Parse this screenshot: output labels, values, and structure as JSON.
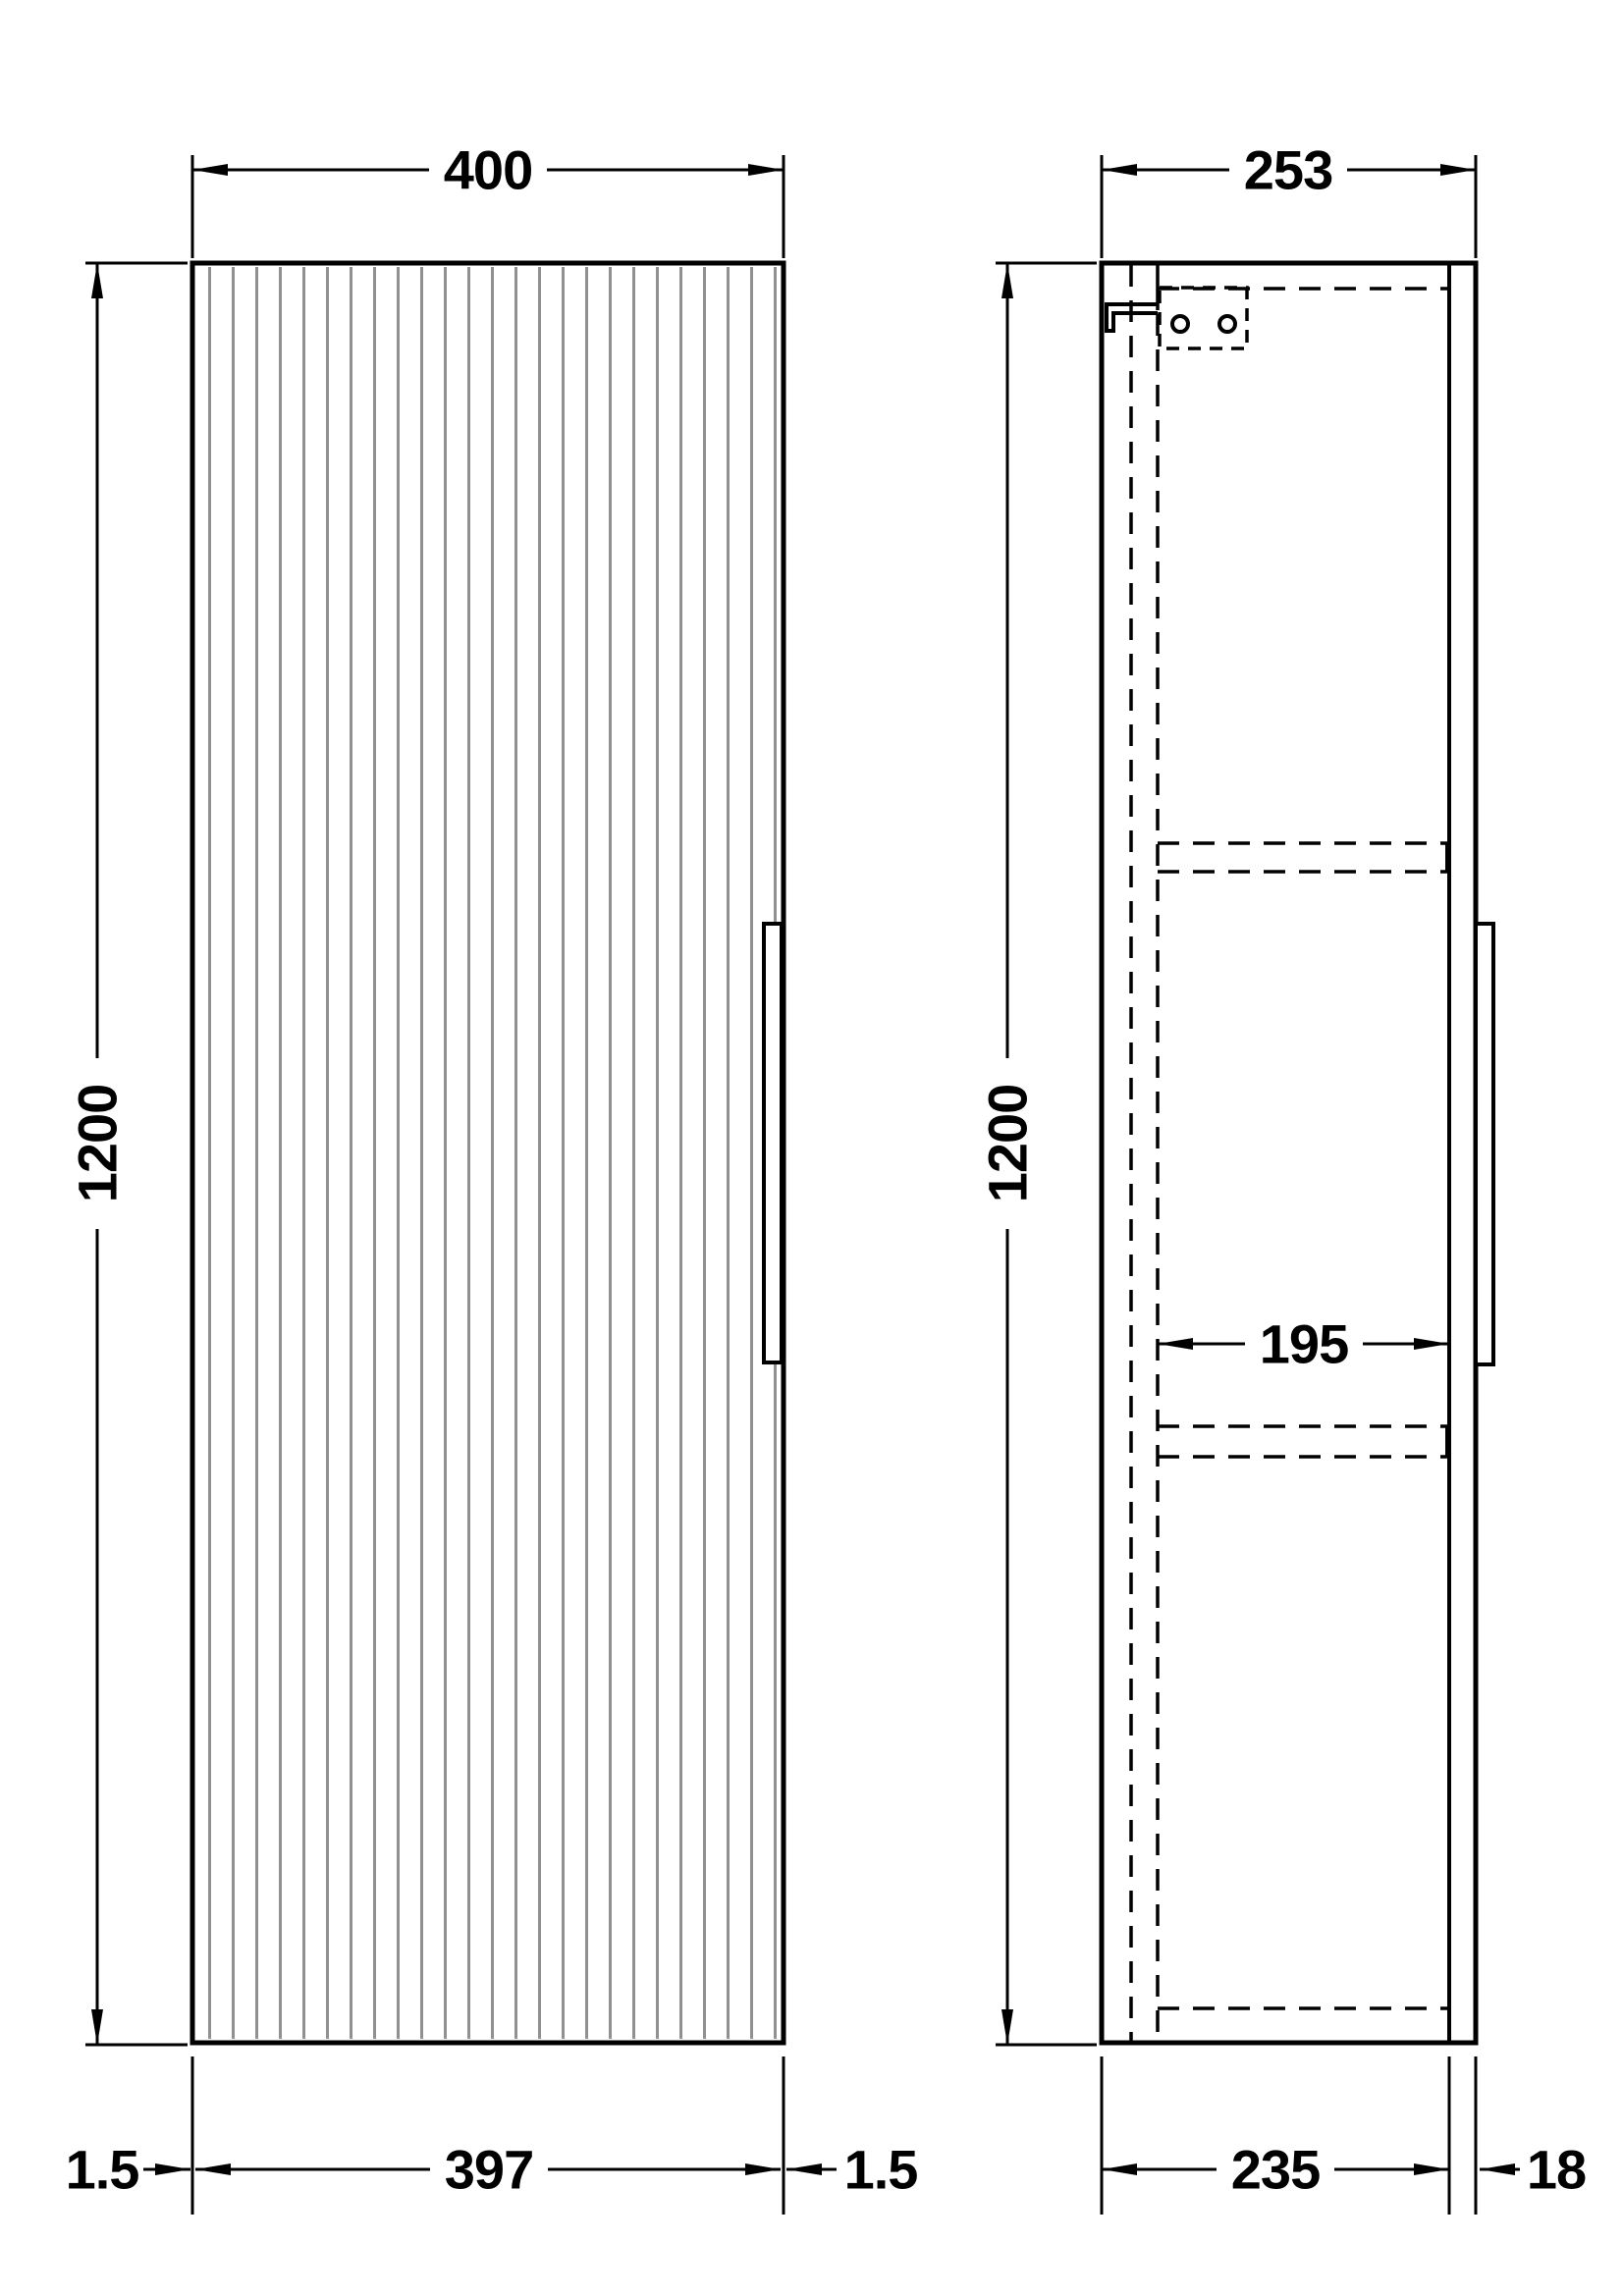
{
  "drawing": {
    "front_view": {
      "width_label": "400",
      "height_label": "1200",
      "bottom": {
        "gap_left_label": "1.5",
        "door_width_label": "397",
        "gap_right_label": "1.5"
      }
    },
    "side_view": {
      "depth_label": "253",
      "height_label": "1200",
      "internal_depth_label": "195",
      "bottom": {
        "carcass_depth_label": "235",
        "door_thickness_label": "18"
      }
    },
    "colors": {
      "line": "#000000",
      "flute": "#909090",
      "background": "#ffffff"
    }
  }
}
